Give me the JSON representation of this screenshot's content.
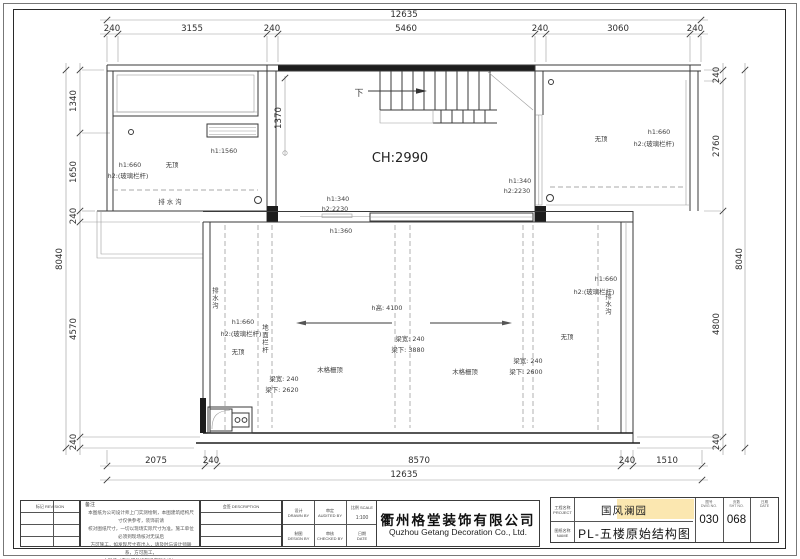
{
  "colors": {
    "redaction": "#fbe7b0",
    "line": "#3a3a3a"
  },
  "dims": {
    "top_total": "12635",
    "top_segs": [
      "240",
      "3155",
      "240",
      "5460",
      "240",
      "3060",
      "240"
    ],
    "bottom_segs": [
      "2075",
      "240",
      "8570",
      "240",
      "1510"
    ],
    "bottom_total": "12635",
    "left_segs": [
      "1340",
      "1650",
      "240",
      "4570",
      "240"
    ],
    "left_total": "8040",
    "right_segs": [
      "240",
      "2760",
      "4800",
      "240"
    ],
    "right_total": "8040",
    "stair_bay": "1370"
  },
  "plan": {
    "ch": "CH:2990",
    "down": "下",
    "tl": {
      "h1_inner": "h1:1560",
      "no_roof": "无顶",
      "h1": "h1:660",
      "h2": "h2:(玻璃栏杆)",
      "gutter": "排 水 沟"
    },
    "tr": {
      "no_roof": "无顶",
      "h1": "h1:660",
      "h2": "h2:(玻璃栏杆)"
    },
    "wall": {
      "h1": "h1:340",
      "h2": "h2:2230",
      "h1r": "h1:340",
      "h2r": "h2:2230",
      "sill": "h1:360"
    },
    "main": {
      "gutter_l": "排水沟",
      "h1_l": "h1:660",
      "h2_l": "h2:(玻璃栏杆)",
      "no_roof_l": "无顶",
      "rail": "地面栏杆",
      "beam1_w": "梁宽: 240",
      "beam1_u": "梁下: 2620",
      "hh": "h高: 4100",
      "beam2_w": "梁宽: 240",
      "beam2_u": "梁下: 3880",
      "beam3_w": "梁宽: 240",
      "beam3_u": "梁下: 2600",
      "wood1": "木格栅顶",
      "wood2": "木格栅顶",
      "no_roof_r": "无顶",
      "gutter_r": "排水沟",
      "h1_r": "h1:660",
      "h2_r": "h2:(玻璃栏杆)"
    }
  },
  "tb": {
    "rev_header": "标记  REVISION",
    "sign_header": "会签  DESCRIPTION",
    "notes_label": "备注",
    "notes": "本图纸为公司设计师上门实测绘制，本图建筑结构尺寸仅供参考，装饰前请\n校对图纸尺寸，一切以现场实际尺寸为准。施工单位必须到现场核对无误后\n方可施工，如发现尺寸有出入，请及时与设计师联系，方可施工，\n本图纸（未注明处按现场实际为准）。",
    "f_design": "设计\nDRAWN BY",
    "f_audit": "审定\nAUDITED BY",
    "f_scale": "比例 SCALE",
    "f_scale_v": "1:100",
    "f_draft": "制图\nDESIGN BY",
    "f_check": "审核\nCHECKED BY",
    "f_date": "日期\nDATE",
    "company_cn": "衢州格堂装饰有限公司",
    "company_en": "Quzhou Getang Decoration Co., Ltd.",
    "lbl_project": "工程名称\nPROJECT",
    "lbl_name": "图纸名称\nNAME",
    "project": "国风澜园",
    "title": "PL-五楼原始结构图",
    "h_fig": "图号\nDWG NO.",
    "h_sheet": "页数\nSHT NO.",
    "h_date": "日期\nDATE",
    "fig": "030",
    "sheet": "068"
  }
}
